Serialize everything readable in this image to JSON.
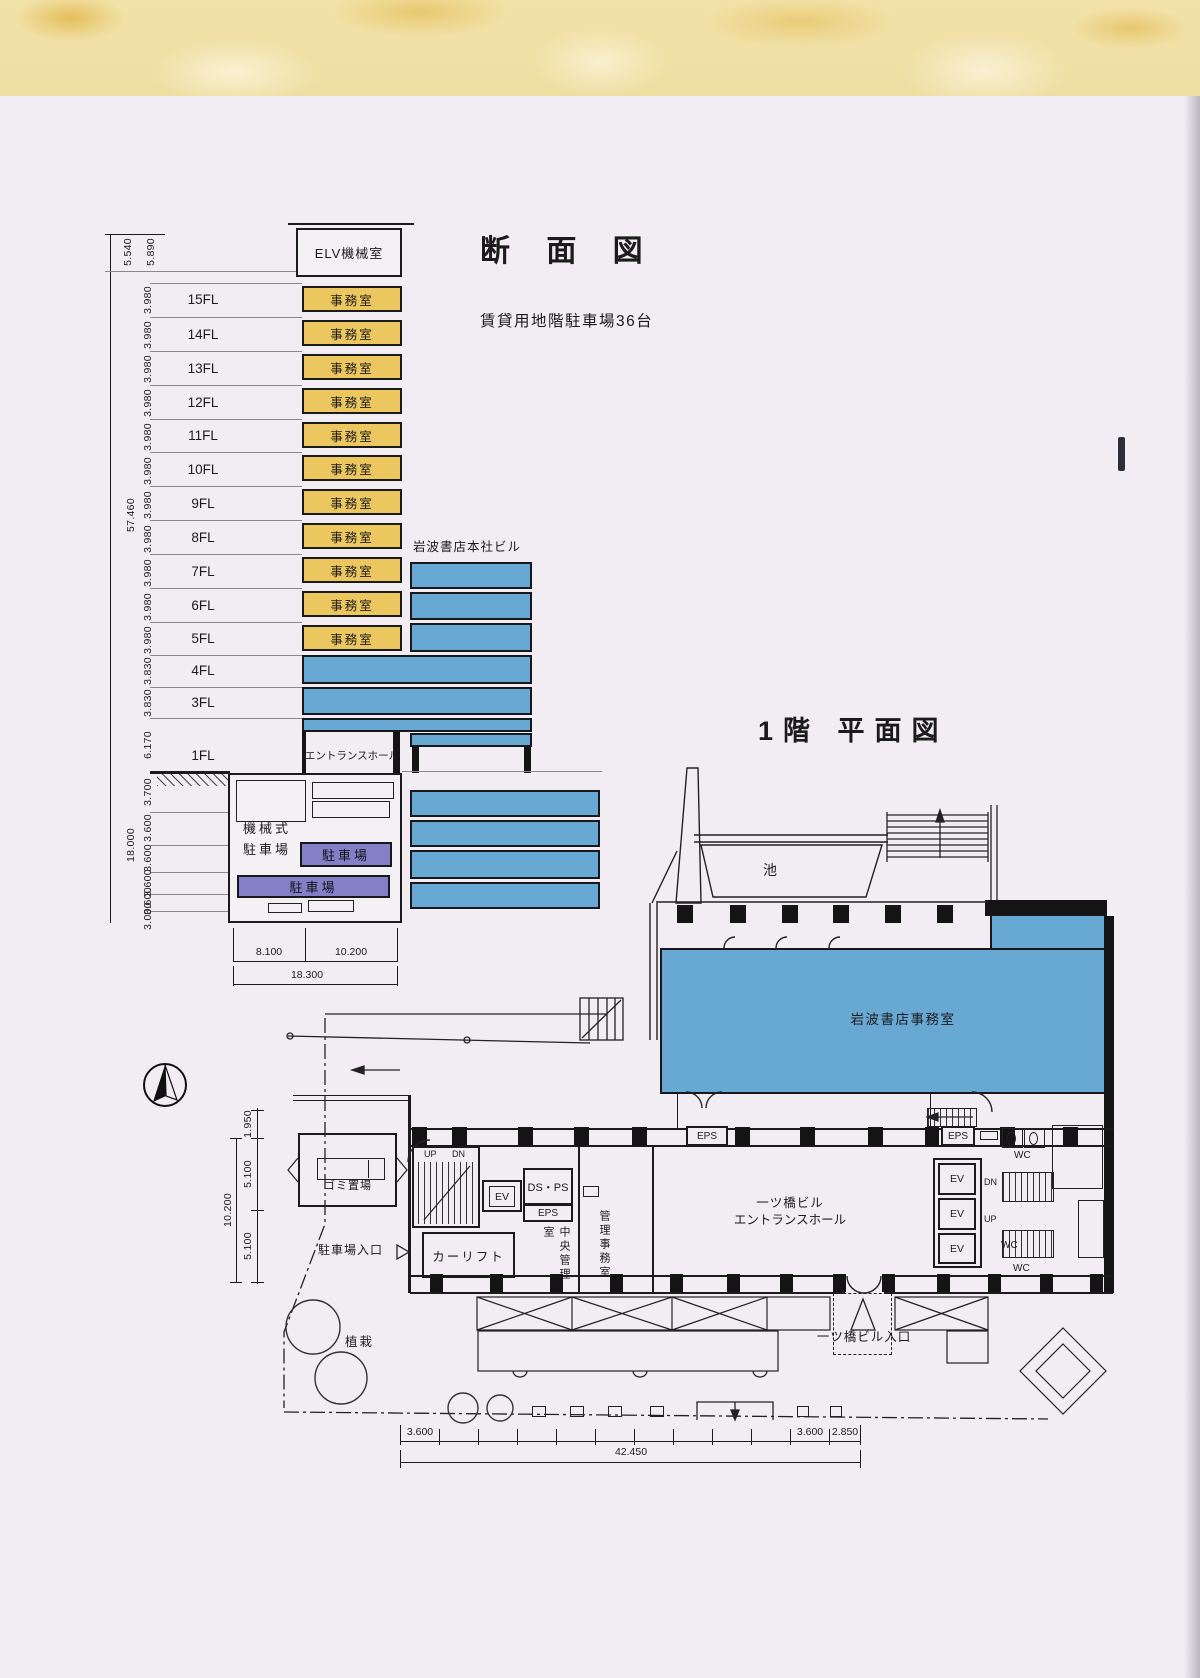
{
  "colors": {
    "paper": "#f1edf3",
    "line": "#1b1b1b",
    "office_yellow": "#ecc65e",
    "building_blue": "#68a9d3",
    "parking_purple": "#8480c7",
    "marble_cream": "#f2e2a8"
  },
  "section": {
    "title": "断 面 図",
    "subtitle": "賃貸用地階駐車場36台",
    "annex_label": "岩波書店本社ビル",
    "elv_room": "ELV機械室",
    "office_label": "事務室",
    "entrance_hall": "エントランスホール",
    "total_height": "57.460",
    "underground_total": "18.000",
    "parapet_dims": [
      "5.540",
      "5.890"
    ],
    "floors": [
      {
        "label": "15FL",
        "dim": "3.980"
      },
      {
        "label": "14FL",
        "dim": "3.980"
      },
      {
        "label": "13FL",
        "dim": "3.980"
      },
      {
        "label": "12FL",
        "dim": "3.980"
      },
      {
        "label": "11FL",
        "dim": "3.980"
      },
      {
        "label": "10FL",
        "dim": "3.980"
      },
      {
        "label": "9FL",
        "dim": "3.980"
      },
      {
        "label": "8FL",
        "dim": "3.980"
      },
      {
        "label": "7FL",
        "dim": "3.980"
      },
      {
        "label": "6FL",
        "dim": "3.980"
      },
      {
        "label": "5FL",
        "dim": "3.980"
      },
      {
        "label": "4FL",
        "dim": "3.830"
      },
      {
        "label": "3FL",
        "dim": "3.830"
      },
      {
        "label": "1FL",
        "dim": "6.170"
      }
    ],
    "underground_dims": [
      "3.700",
      "3.600",
      "3.600",
      "3.600",
      "3.600",
      "3.000"
    ],
    "mech_parking": [
      "機械式",
      "駐車場"
    ],
    "parking_label": "駐車場",
    "width_dims": {
      "left": "8.100",
      "right": "10.200",
      "total": "18.300"
    }
  },
  "plan": {
    "title": "1階 平面図",
    "pond": "池",
    "office": "岩波書店事務室",
    "hall": [
      "一ツ橋ビル",
      "エントランスホール"
    ],
    "entrance": "一ツ橋ビル入口",
    "parking_entrance": "駐車場入口",
    "car_lift": "カーリフト",
    "central_control": "中央管理室",
    "admin_office": "管理事務室",
    "garbage": "ゴミ置場",
    "planting": "植栽",
    "ev": "EV",
    "eps": "EPS",
    "ds_ps": "DS・PS",
    "wc": "WC",
    "up": "UP",
    "dn": "DN",
    "dims": {
      "left_top": "1.950",
      "left_mid": "5.100",
      "left_bottom": "5.100",
      "left_total": "10.200",
      "bottom_first": "3.600",
      "bottom_second": "3.600",
      "bottom_third": "2.850",
      "bottom_total": "42.450"
    }
  }
}
